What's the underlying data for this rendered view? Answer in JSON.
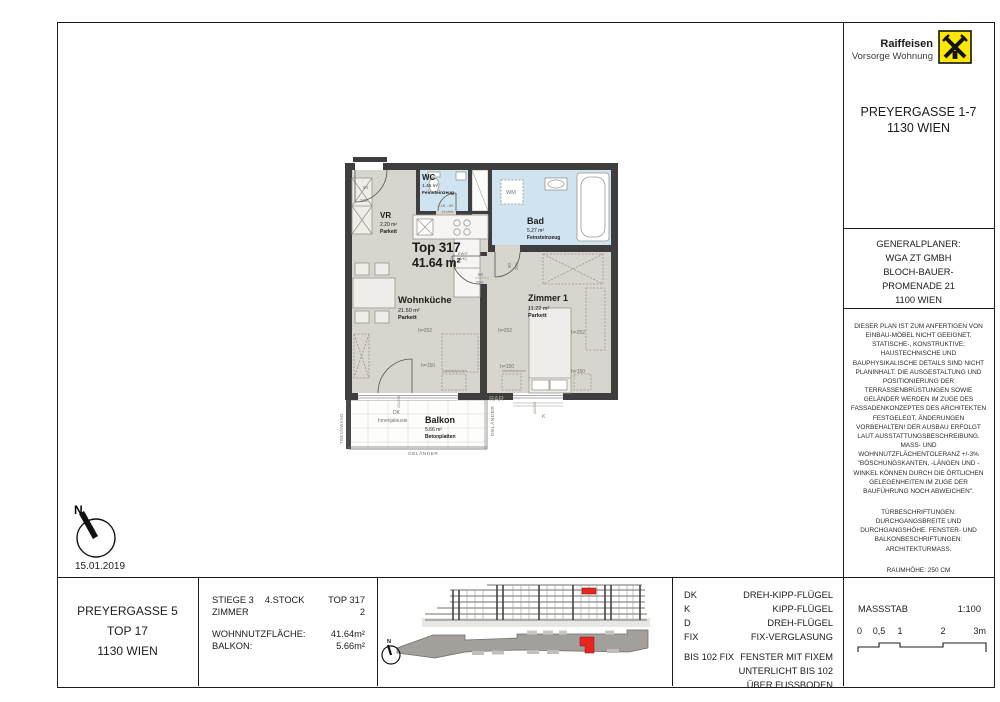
{
  "header": {
    "brand_line1": "Raiffeisen",
    "brand_line2": "Vorsorge Wohnung",
    "project_title": "PREYERGASSE 1-7",
    "project_city": "1130 WIEN"
  },
  "generalplaner": {
    "title": "GENERALPLANER:",
    "line1": "WGA ZT GMBH",
    "line2": "BLOCH-BAUER-",
    "line3": "PROMENADE 21",
    "line4": "1100 WIEN"
  },
  "notes": {
    "para1": "DIESER PLAN IST ZUM ANFERTIGEN VON EINBAU-MÖBEL NICHT GEEIGNET. STATISCHE-, KONSTRUKTIVE; HAUSTECHNISCHE UND BAUPHYSIKALISCHE DETAILS SIND NICHT PLANINHALT. DIE AUSGESTALTUNG UND POSITIONIERUNG DER TERRASSENBRÜSTUNGEN SOWIE GELÄNDER WERDEN IM ZUGE DES FASSADENKONZEPTES DES ARCHITEKTEN FESTGELEGT. ÄNDERUNGEN VORBEHALTEN! DER AUSBAU ERFOLGT LAUT AUSSTATTUNGSBESCHREIBUNG. MASS- UND WOHNNUTZFLÄCHENTOLERANZ +/-3% \"BÖSCHUNGSKANTEN, -LÄNGEN UND -WINKEL KÖNNEN DURCH DIE ÖRTLICHEN GELEGENHEITEN IM ZUGE DER BAUFÜHRUNG NOCH ABWEICHEN\".",
    "para2": "TÜRBESCHRIFTUNGEN: DURCHGANGSBREITE UND DURCHGANGSHÖHE. FENSTER- UND BALKONBESCHRIFTUNGEN: ARCHITEKTURMASS.",
    "para3": "RAUMHÖHE: 250 CM"
  },
  "plan": {
    "unit_title": "Top 317",
    "unit_area": "41.64 m²",
    "north_label": "N",
    "date": "15.01.2019",
    "rooms": {
      "vr": {
        "name": "VR",
        "area": "2.20 m²",
        "floor": "Parkett"
      },
      "wc": {
        "name": "WC",
        "area": "1.45 m²",
        "floor": "Feinsteinzeug"
      },
      "bad": {
        "name": "Bad",
        "area": "5.27 m²",
        "floor": "Feinsteinzeug"
      },
      "wohnkueche": {
        "name": "Wohnküche",
        "area": "21.50 m²",
        "floor": "Parkett"
      },
      "zimmer1": {
        "name": "Zimmer 1",
        "area": "11.22 m²",
        "floor": "Parkett"
      },
      "balkon": {
        "name": "Balkon",
        "area": "5.66 m²",
        "floor": "Betonplatten"
      }
    },
    "labels": {
      "wm": "WM",
      "rar": "RAR",
      "trennwand": "TRENNWAND",
      "gelaender": "GELÄNDER",
      "dk": "DK",
      "innenjalousie": "Innenjalousie",
      "h252": "h=252",
      "h150": "h=150",
      "hvert": "H-Vert",
      "t1b": "T1B - 80",
      "ewt1": "EW/T",
      "ewt2": "(4/K)",
      "k": "K",
      "nachtkaestchen": "Nachtkästchen",
      "door_wc_w": "60",
      "door_wc_h": "200",
      "door_bad_w": "90",
      "door_bad_h": "200",
      "door_zimmer_w": "80",
      "door_zimmer_h": "200",
      "window_dim": "252/239"
    }
  },
  "titleblock": {
    "address_line1": "PREYERGASSE 5",
    "address_line2": "TOP 17",
    "address_line3": "1130 WIEN",
    "info": {
      "stiege": "STIEGE 3",
      "stock": "4.STOCK",
      "top": "TOP 317",
      "zimmer_label": "ZIMMER",
      "zimmer_value": "2",
      "wnf_label": "WOHNNUTZFLÄCHE:",
      "wnf_value": "41.64m²",
      "balkon_label": "BALKON:",
      "balkon_value": "5.66m²"
    },
    "legend": [
      {
        "abbr": "DK",
        "label": "DREH-KIPP-FLÜGEL"
      },
      {
        "abbr": "K",
        "label": "KIPP-FLÜGEL"
      },
      {
        "abbr": "D",
        "label": "DREH-FLÜGEL"
      },
      {
        "abbr": "FIX",
        "label": "FIX-VERGLASUNG"
      }
    ],
    "legend_note": {
      "abbr": "BIS 102 FIX",
      "line1": "FENSTER MIT FIXEM",
      "line2": "UNTERLICHT BIS 102",
      "line3": "ÜBER FUSSBODEN"
    },
    "massstab": {
      "label": "MASSSTAB",
      "ratio": "1:100",
      "t0": "0",
      "t05": "0,5",
      "t1": "1",
      "t2": "2",
      "t3": "3m"
    }
  },
  "colors": {
    "wall": "#3e3e3e",
    "parkett": "#d8d4ce",
    "wet": "#cfe3f0",
    "highlight": "#e8251f",
    "brand_yellow": "#ffe800"
  }
}
